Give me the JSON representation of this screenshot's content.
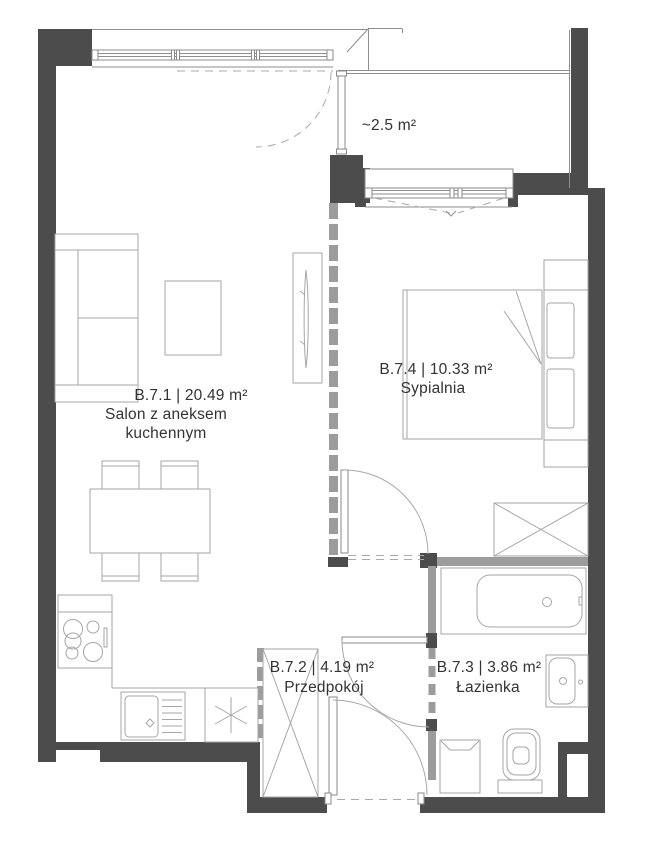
{
  "plan": {
    "rooms": {
      "living": {
        "code": "B.7.1 | 20.49 m²",
        "name_line1": "Salon z aneksem",
        "name_line2": "kuchennym"
      },
      "bedroom": {
        "code": "B.7.4 | 10.33 m²",
        "name": "Sypialnia"
      },
      "hallway": {
        "code": "B.7.2 | 4.19 m²",
        "name": "Przedpokój"
      },
      "bathroom": {
        "code": "B.7.3 | 3.86 m²",
        "name": "Łazienka"
      },
      "balcony": {
        "area": "~2.5 m²"
      }
    },
    "colors": {
      "wall": "#4c4c4c",
      "partition": "#9c9c9c",
      "outline": "#8e8e8e",
      "furniture": "#a6a6a6",
      "text": "#333333"
    }
  }
}
